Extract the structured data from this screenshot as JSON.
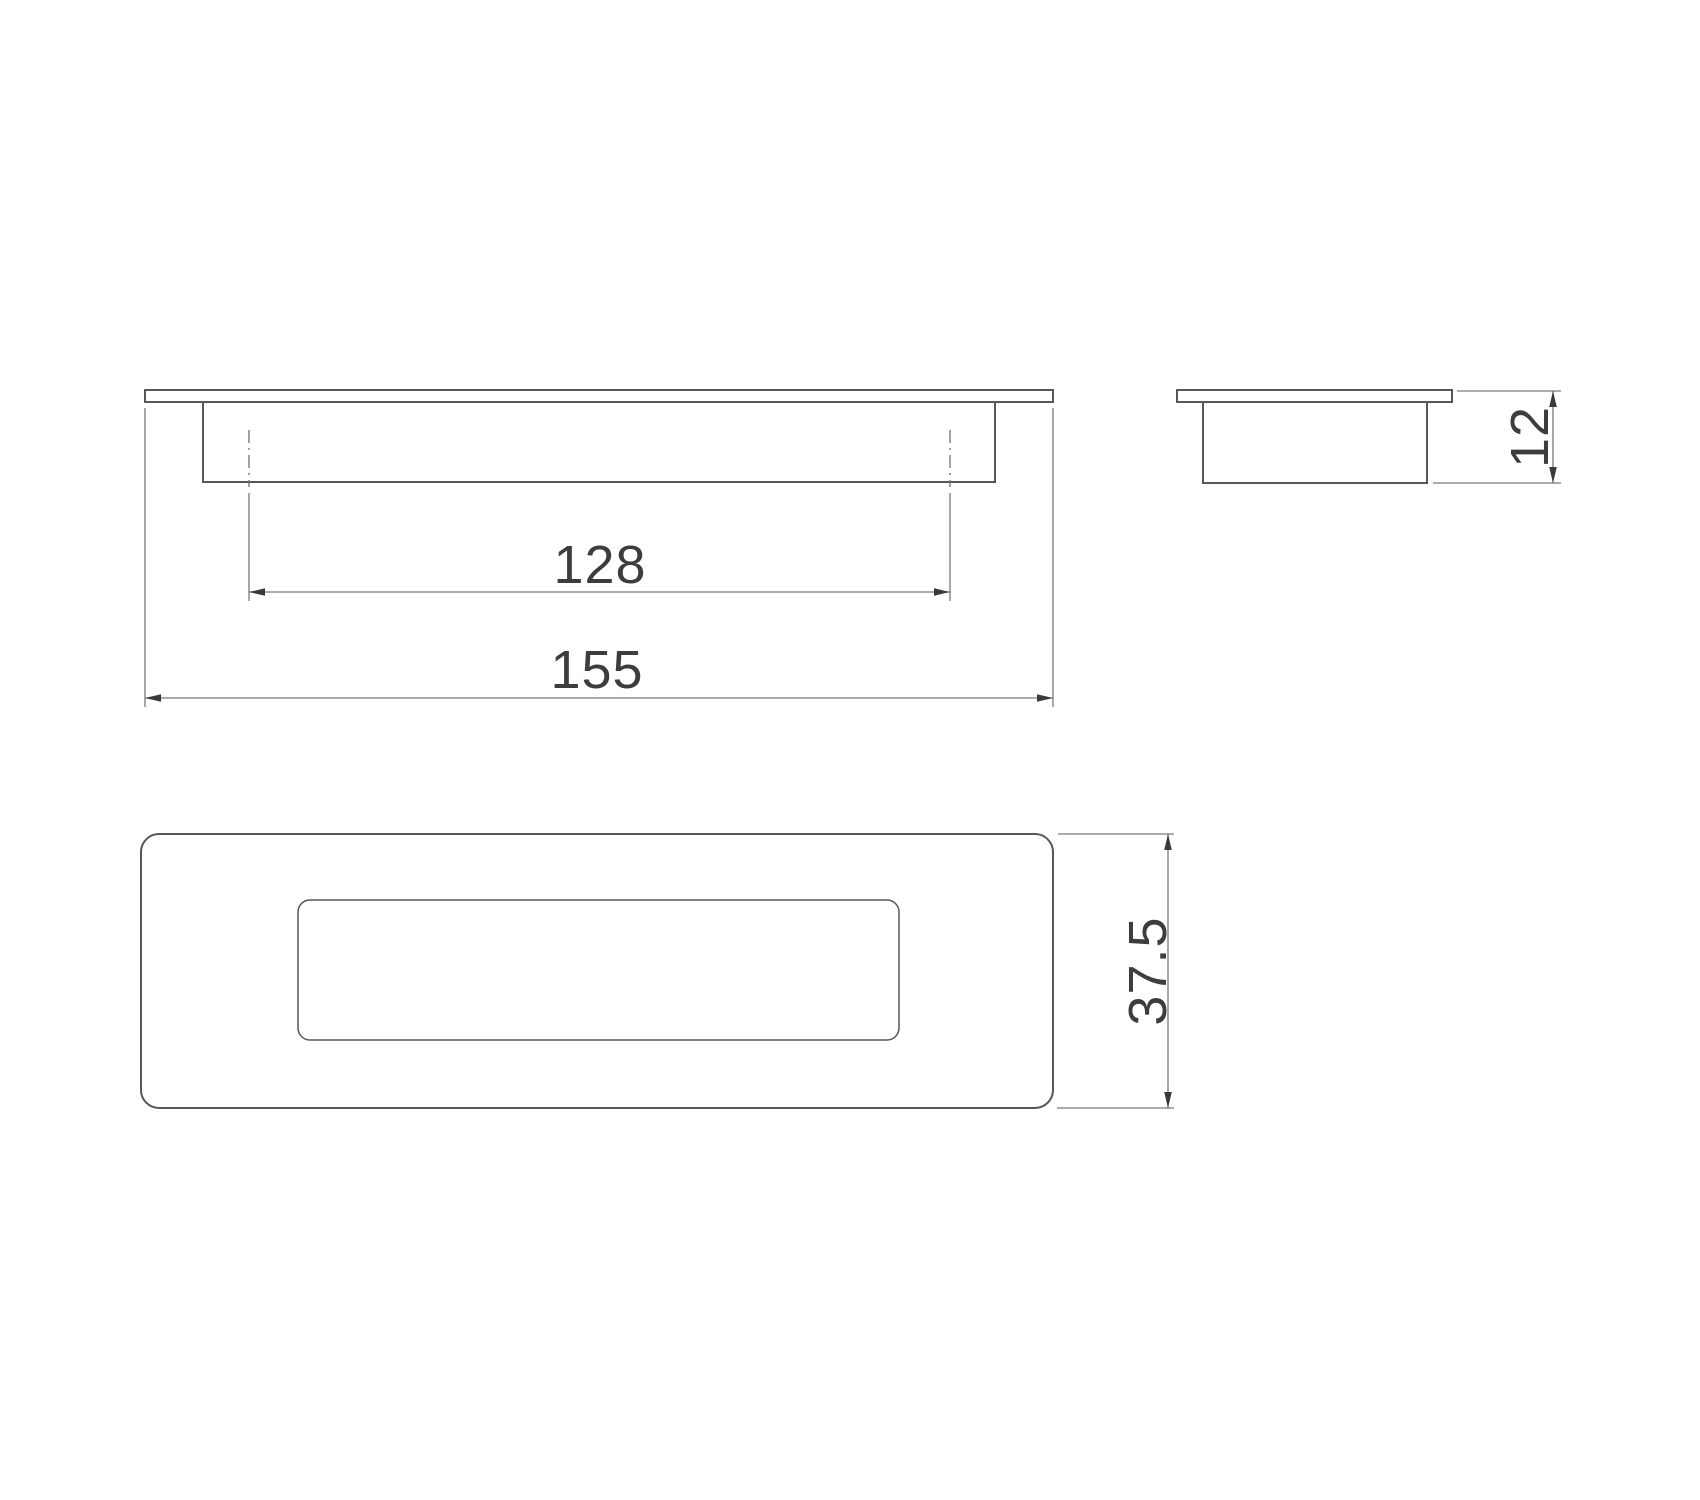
{
  "drawing": {
    "dimensions": {
      "hole_spacing": "128",
      "overall_length": "155",
      "depth": "12",
      "width": "37.5"
    },
    "colors": {
      "object_line": "#575757",
      "dim_line": "#7a7a7a",
      "centerline": "#6f6f6f",
      "arrow": "#3a3a3a",
      "text": "#3d3d3d",
      "background": "#ffffff"
    }
  }
}
